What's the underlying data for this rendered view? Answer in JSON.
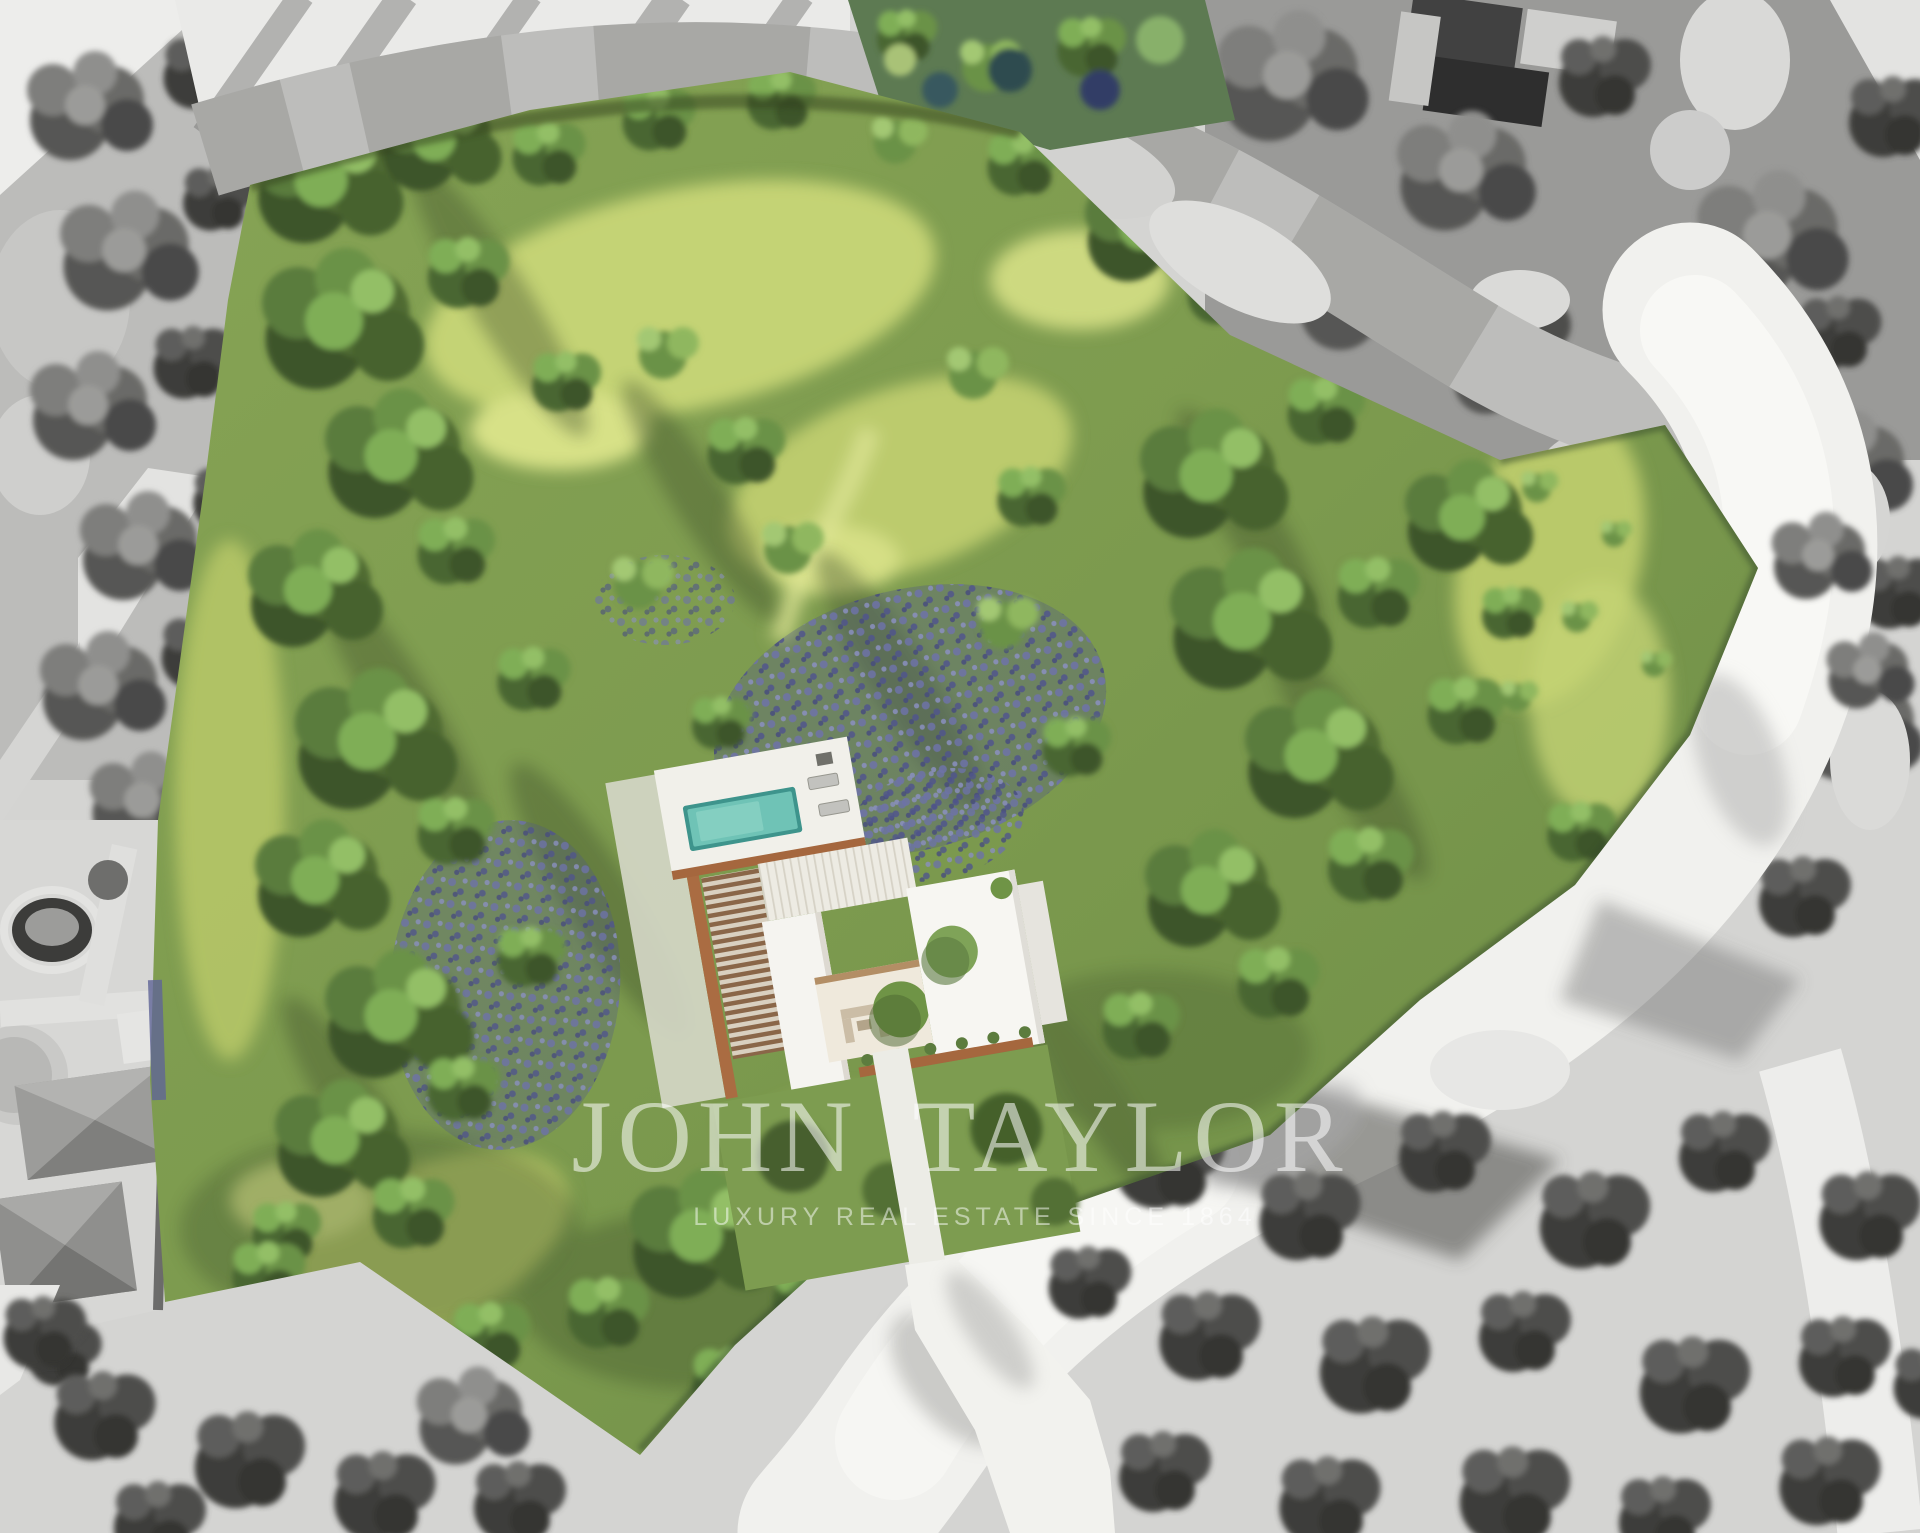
{
  "watermark": {
    "title": "JOHN TAYLOR",
    "tagline": "LUXURY REAL ESTATE SINCE 1864"
  },
  "scene": {
    "kind": "aerial-property-render",
    "plot_rendering": "full color",
    "surroundings_rendering": "desaturated grayscale"
  },
  "palette": {
    "meadow_yellow_green": "#c9d77c",
    "tree_dark_green": "#3d5429",
    "tree_mid_green": "#6b9247",
    "tree_light_green": "#93bf66",
    "lavender_purple": "#6d72a6",
    "pool_water_teal": "#6fc3b6",
    "terracotta_wall": "#aa6c42",
    "villa_white": "#f4f3ef",
    "road_white": "#f1f1ee",
    "gray_tree": "#4f4f4d",
    "ground_gray": "#d8d8d6",
    "watermark_white": "#ffffff"
  }
}
